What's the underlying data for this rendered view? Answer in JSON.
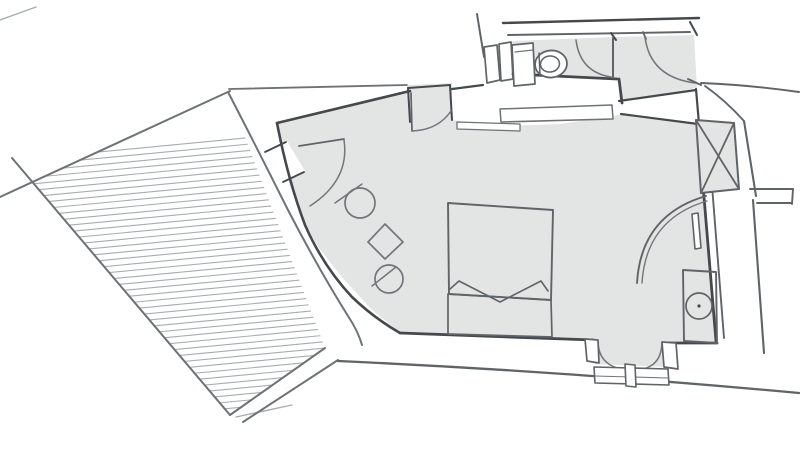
{
  "meta": {
    "kind": "hand-sketched architectural floor plan, no visible text labels",
    "canvas": {
      "width": 800,
      "height": 458,
      "background": "#ffffff"
    }
  },
  "palette": {
    "dark": "#45494d",
    "mediumdark": "#5f6468",
    "medium": "#6d7276",
    "furniture": "#71767a",
    "light": "#a7acaf",
    "floor": "#e3e5e4",
    "white": "#ffffff",
    "none": "none"
  },
  "floorplan": {
    "rooms": [
      {
        "name": "terrace",
        "finish": "hatched-decking"
      },
      {
        "name": "bedroom",
        "finish": "grey-floor"
      },
      {
        "name": "bathroom",
        "finish": "grey-floor"
      },
      {
        "name": "entry-vestibule",
        "finish": "grey-floor"
      }
    ],
    "furniture": [
      "double-bed",
      "two-round-chairs",
      "square-side-table",
      "toilet",
      "vanity-with-round-basin",
      "radiator-bar",
      "curved-screen",
      "service-shaft"
    ],
    "doors": [
      "terrace-entry-door",
      "bathroom-door",
      "unit-entry-door",
      "wardrobe-niche-door",
      "double-french-door"
    ],
    "shapes": [
      {
        "name": "bedroom-floor",
        "kind": "polygon",
        "points": "277,123 408,90 408,85 452,83 452,120 500,126 560,124 614,116 621,114 698,125 716,341 672,343 668,343 668,367 594,364 593,341 400,333 370,308 342,277 318,247 301,216 290,186 282,155",
        "fill": "floor",
        "stroke": "none",
        "w": 0
      },
      {
        "name": "bathroom-floor",
        "kind": "polygon",
        "points": "512,41 613,37 694,35 697,88 620,101 619,79 513,74",
        "fill": "floor",
        "stroke": "none",
        "w": 0
      },
      {
        "name": "terrace-deck-hatch",
        "kind": "hatch",
        "points": "32,182 228,92 325,348 230,415",
        "x0": 14,
        "x1": 346,
        "yStart": 160,
        "yEnd": 436,
        "spacing": 6.4,
        "slope": -0.095,
        "stroke": "light",
        "w": 1.1
      },
      {
        "name": "terrace-edge-top",
        "kind": "path",
        "d": "M0,197 L230,91",
        "stroke": "medium",
        "w": 2
      },
      {
        "name": "terrace-edge-left",
        "kind": "path",
        "d": "M12,158 L230,415",
        "stroke": "medium",
        "w": 2
      },
      {
        "name": "terrace-outer-curve",
        "kind": "path",
        "d": "M228,92 Q258,150 288,210 Q318,268 348,316 Q358,331 362,345",
        "stroke": "medium",
        "w": 2
      },
      {
        "name": "terrace-edge-bottom",
        "kind": "path",
        "d": "M230,415 L325,348",
        "stroke": "medium",
        "w": 2
      },
      {
        "name": "terrace-fold-line",
        "kind": "path",
        "d": "M236,417 L292,405",
        "stroke": "light",
        "w": 1.4
      },
      {
        "name": "terrace-outer-bottom-wall",
        "kind": "path",
        "d": "M243,422 L338,360",
        "stroke": "medium",
        "w": 2
      },
      {
        "name": "exterior-long-wall",
        "kind": "path",
        "d": "M338,361 Q560,371 799,393",
        "stroke": "mediumdark",
        "w": 2.3
      },
      {
        "name": "corner-sketch-line",
        "kind": "path",
        "d": "M0,20 L36,7",
        "stroke": "light",
        "w": 1.4
      },
      {
        "name": "entry-door-opening",
        "kind": "polygon",
        "points": "265,151 287,141 305,171 283,181",
        "fill": "white",
        "stroke": "none",
        "w": 0
      },
      {
        "name": "entry-door-jamb-upper",
        "kind": "path",
        "d": "M265,152 L286,142",
        "stroke": "dark",
        "w": 1.8
      },
      {
        "name": "entry-door-jamb-lower",
        "kind": "path",
        "d": "M283,182 L304,172",
        "stroke": "dark",
        "w": 1.8
      },
      {
        "name": "entry-door-leaf",
        "kind": "path",
        "d": "M299,146 L344,139",
        "stroke": "mediumdark",
        "w": 1.8
      },
      {
        "name": "entry-door-swing-arc",
        "kind": "path",
        "d": "M344,140 Q350,180 310,206",
        "stroke": "furniture",
        "w": 1.5
      },
      {
        "name": "bedroom-top-wall-inner",
        "kind": "path",
        "d": "M277,123 L410,91",
        "stroke": "dark",
        "w": 2.6
      },
      {
        "name": "bedroom-top-wall-outer",
        "kind": "path",
        "d": "M229,89 L407,85",
        "stroke": "medium",
        "w": 1.8
      },
      {
        "name": "bedroom-curved-wall",
        "kind": "path",
        "d": "M277,123 Q288,180 305,225 Q323,266 352,297 Q374,318 400,333",
        "stroke": "dark",
        "w": 2.6
      },
      {
        "name": "niche-left-jamb",
        "kind": "path",
        "d": "M408,88 L410,122",
        "stroke": "dark",
        "w": 2
      },
      {
        "name": "niche-top-edge",
        "kind": "path",
        "d": "M408,88 L450,85",
        "stroke": "dark",
        "w": 2
      },
      {
        "name": "niche-right-jamb",
        "kind": "path",
        "d": "M450,85 L452,120",
        "stroke": "dark",
        "w": 2
      },
      {
        "name": "niche-door-leaf",
        "kind": "path",
        "d": "M411,93 L412,131",
        "stroke": "mediumdark",
        "w": 1.7
      },
      {
        "name": "niche-door-swing-arc",
        "kind": "path",
        "d": "M412,131 Q438,130 451,111",
        "stroke": "furniture",
        "w": 1.5
      },
      {
        "name": "wall-step-line",
        "kind": "path",
        "d": "M452,89 L483,85",
        "stroke": "dark",
        "w": 2.2
      },
      {
        "name": "bath-window-bar-1",
        "kind": "polygon",
        "points": "484,47 497,45 500,80 487,83",
        "fill": "white",
        "stroke": "mediumdark",
        "w": 1.7
      },
      {
        "name": "bath-window-bar-2",
        "kind": "polygon",
        "points": "499,44 511,42 513,79 501,81",
        "fill": "white",
        "stroke": "mediumdark",
        "w": 1.7
      },
      {
        "name": "bath-left-end-line",
        "kind": "path",
        "d": "M477,14 L484,57",
        "stroke": "mediumdark",
        "w": 2
      },
      {
        "name": "top-wall-outer",
        "kind": "path",
        "d": "M503,23 L699,18",
        "stroke": "dark",
        "w": 2.4
      },
      {
        "name": "top-wall-inner",
        "kind": "path",
        "d": "M508,35 L690,32",
        "stroke": "mediumdark",
        "w": 1.9
      },
      {
        "name": "top-wall-right-cap",
        "kind": "path",
        "d": "M690,22 L697,35",
        "stroke": "dark",
        "w": 2
      },
      {
        "name": "bath-door-hinge-tick",
        "kind": "path",
        "d": "M611,33 L616,40",
        "stroke": "dark",
        "w": 2
      },
      {
        "name": "entry-arc-tick",
        "kind": "path",
        "d": "M643,32 L646,39",
        "stroke": "mediumdark",
        "w": 1.8
      },
      {
        "name": "bathroom-bottom-wall",
        "kind": "path",
        "d": "M513,74 L617,79",
        "stroke": "dark",
        "w": 2.8
      },
      {
        "name": "vestibule-left-jamb",
        "kind": "path",
        "d": "M619,79 L622,103",
        "stroke": "dark",
        "w": 2.8
      },
      {
        "name": "bath-partition-stub",
        "kind": "path",
        "d": "M613,38 L613,78",
        "stroke": "mediumdark",
        "w": 2
      },
      {
        "name": "bathroom-door-swing-arc",
        "kind": "path",
        "d": "M576,40 Q580,72 611,77",
        "stroke": "furniture",
        "w": 1.5
      },
      {
        "name": "unit-entry-door-swing-arc",
        "kind": "path",
        "d": "M645,37 Q650,77 695,83",
        "stroke": "furniture",
        "w": 1.5
      },
      {
        "name": "wall-corner-tick",
        "kind": "path",
        "d": "M688,79 L701,85",
        "stroke": "mediumdark",
        "w": 2
      },
      {
        "name": "toilet-cistern",
        "kind": "polygon",
        "points": "512,45 533,43 535,84 514,86",
        "fill": "white",
        "stroke": "mediumdark",
        "w": 1.7
      },
      {
        "name": "toilet-cistern-line",
        "kind": "path",
        "d": "M515,52 L533,50",
        "stroke": "furniture",
        "w": 1.2
      },
      {
        "name": "toilet-bowl",
        "kind": "ellipse",
        "cx": 551,
        "cy": 64,
        "rx": 16,
        "ry": 13.5,
        "rot": -6,
        "fill": "white",
        "stroke": "mediumdark",
        "w": 1.8
      },
      {
        "name": "toilet-bowl-inner",
        "kind": "ellipse",
        "cx": 550,
        "cy": 64,
        "rx": 9.5,
        "ry": 8,
        "rot": -6,
        "fill": "none",
        "stroke": "mediumdark",
        "w": 1.5
      },
      {
        "name": "toilet-seat-bar",
        "kind": "path",
        "d": "M539,53 L540,75",
        "stroke": "mediumdark",
        "w": 1.5
      },
      {
        "name": "vestibule-wall-top",
        "kind": "path",
        "d": "M619,101 L696,90",
        "stroke": "dark",
        "w": 2.2
      },
      {
        "name": "vestibule-wall-bottom",
        "kind": "path",
        "d": "M621,114 L698,124",
        "stroke": "dark",
        "w": 2.2
      },
      {
        "name": "vestibule-wall-jamb",
        "kind": "path",
        "d": "M696,89 L699,124",
        "stroke": "dark",
        "w": 2.2
      },
      {
        "name": "wall-shelf-strip-long",
        "kind": "polygon",
        "points": "500,109 612,105 613,119 501,122",
        "fill": "white",
        "stroke": "medium",
        "w": 1.5
      },
      {
        "name": "wall-shelf-strip-short",
        "kind": "polygon",
        "points": "457,122 520,124 520,131 457,129",
        "fill": "white",
        "stroke": "medium",
        "w": 1.3
      },
      {
        "name": "right-wall-inner",
        "kind": "path",
        "d": "M698,125 L716,341",
        "stroke": "dark",
        "w": 2.8
      },
      {
        "name": "right-wall-outer",
        "kind": "path",
        "d": "M707,122 L724,338",
        "stroke": "mediumdark",
        "w": 1.9
      },
      {
        "name": "bottom-wall-left",
        "kind": "path",
        "d": "M400,333 L593,340",
        "stroke": "dark",
        "w": 2.8
      },
      {
        "name": "bottom-wall-right",
        "kind": "path",
        "d": "M668,343 L717,343",
        "stroke": "dark",
        "w": 2.8
      },
      {
        "name": "french-door-arc-left",
        "kind": "path",
        "d": "M598,342 Q599,368 629,370",
        "stroke": "furniture",
        "w": 1.5
      },
      {
        "name": "french-door-arc-right",
        "kind": "path",
        "d": "M662,343 Q661,370 633,370",
        "stroke": "furniture",
        "w": 1.5
      },
      {
        "name": "french-door-left-jamb",
        "kind": "polygon",
        "points": "585,339 598,340 599,363 587,361",
        "fill": "white",
        "stroke": "mediumdark",
        "w": 1.7
      },
      {
        "name": "french-door-right-jamb",
        "kind": "polygon",
        "points": "662,342 676,343 678,369 664,367",
        "fill": "white",
        "stroke": "mediumdark",
        "w": 1.7
      },
      {
        "name": "french-door-threshold",
        "kind": "polygon",
        "points": "594,367 668,369 669,385 595,383",
        "fill": "white",
        "stroke": "mediumdark",
        "w": 1.6
      },
      {
        "name": "french-door-threshold-line",
        "kind": "path",
        "d": "M595,376 L668,378",
        "stroke": "furniture",
        "w": 1.1
      },
      {
        "name": "french-door-mullion",
        "kind": "polygon",
        "points": "625,364 635,365 636,387 626,386",
        "fill": "white",
        "stroke": "mediumdark",
        "w": 1.6
      },
      {
        "name": "chair-circle-1",
        "kind": "circle",
        "cx": 360,
        "cy": 203,
        "r": 15,
        "fill": "none",
        "stroke": "furniture",
        "w": 1.7
      },
      {
        "name": "chair-back-line-1",
        "kind": "path",
        "d": "M335,203 L362,184",
        "stroke": "furniture",
        "w": 1.5
      },
      {
        "name": "square-side-table",
        "kind": "polygon",
        "points": "385,224 403,242 385,259 368,242",
        "fill": "none",
        "stroke": "furniture",
        "w": 1.7
      },
      {
        "name": "chair-circle-2",
        "kind": "circle",
        "cx": 389,
        "cy": 279,
        "r": 14,
        "fill": "none",
        "stroke": "furniture",
        "w": 1.7
      },
      {
        "name": "chair-back-line-2",
        "kind": "path",
        "d": "M372,286 L396,267",
        "stroke": "furniture",
        "w": 1.5
      },
      {
        "name": "bed-outline",
        "kind": "polygon",
        "points": "448,203 553,210 551,300 449,294",
        "fill": "none",
        "stroke": "mediumdark",
        "w": 1.9
      },
      {
        "name": "bed-blanket-zigzag",
        "kind": "path",
        "d": "M450,289 L459,281 L500,302 L541,281 L548,291",
        "stroke": "mediumdark",
        "w": 1.6
      },
      {
        "name": "bed-footboard",
        "kind": "polygon",
        "points": "448,294 551,300 552,337 448,334",
        "fill": "none",
        "stroke": "mediumdark",
        "w": 1.7
      },
      {
        "name": "vanity-outline",
        "kind": "polygon",
        "points": "683,270 716,272 717,343 684,341",
        "fill": "none",
        "stroke": "mediumdark",
        "w": 1.9
      },
      {
        "name": "vanity-basin-circle",
        "kind": "circle",
        "cx": 699,
        "cy": 306,
        "r": 13,
        "fill": "none",
        "stroke": "mediumdark",
        "w": 1.7
      },
      {
        "name": "vanity-basin-dot",
        "kind": "circle",
        "cx": 699,
        "cy": 306,
        "r": 1.6,
        "fill": "dark",
        "stroke": "none",
        "w": 0
      },
      {
        "name": "radiator-bar",
        "kind": "polygon",
        "points": "692,214 698,213 701,248 695,249",
        "fill": "white",
        "stroke": "mediumdark",
        "w": 1.6
      },
      {
        "name": "curved-screen-outer",
        "kind": "path",
        "d": "M637,283 Q641,215 706,196",
        "stroke": "mediumdark",
        "w": 1.9
      },
      {
        "name": "curved-screen-inner",
        "kind": "path",
        "d": "M642,283 Q646,219 707,201",
        "stroke": "furniture",
        "w": 1.4
      },
      {
        "name": "service-shaft-box",
        "kind": "polygon",
        "points": "696,120 734,123 739,189 701,193",
        "fill": "floor",
        "stroke": "mediumdark",
        "w": 2
      },
      {
        "name": "service-shaft-diagonal-1",
        "kind": "path",
        "d": "M696,120 L739,189",
        "stroke": "mediumdark",
        "w": 1.8
      },
      {
        "name": "service-shaft-diagonal-2",
        "kind": "path",
        "d": "M734,123 L701,193",
        "stroke": "mediumdark",
        "w": 1.8
      },
      {
        "name": "exterior-corner-diagonal",
        "kind": "path",
        "d": "M705,86 Q725,100 744,121",
        "stroke": "mediumdark",
        "w": 1.9
      },
      {
        "name": "exterior-right-wall-upper",
        "kind": "path",
        "d": "M744,121 L756,196",
        "stroke": "mediumdark",
        "w": 2.1
      },
      {
        "name": "wall-stub-top",
        "kind": "path",
        "d": "M750,189 L793,189",
        "stroke": "mediumdark",
        "w": 1.9
      },
      {
        "name": "wall-stub-cap",
        "kind": "path",
        "d": "M793,189 L792,204",
        "stroke": "mediumdark",
        "w": 1.9
      },
      {
        "name": "wall-stub-bottom",
        "kind": "path",
        "d": "M757,203 L792,203",
        "stroke": "mediumdark",
        "w": 1.9
      },
      {
        "name": "exterior-right-wall-lower",
        "kind": "path",
        "d": "M753,200 L764,353",
        "stroke": "mediumdark",
        "w": 2.1
      },
      {
        "name": "top-right-exit-line",
        "kind": "path",
        "d": "M701,83 Q750,85 799,92",
        "stroke": "mediumdark",
        "w": 1.9
      }
    ]
  }
}
